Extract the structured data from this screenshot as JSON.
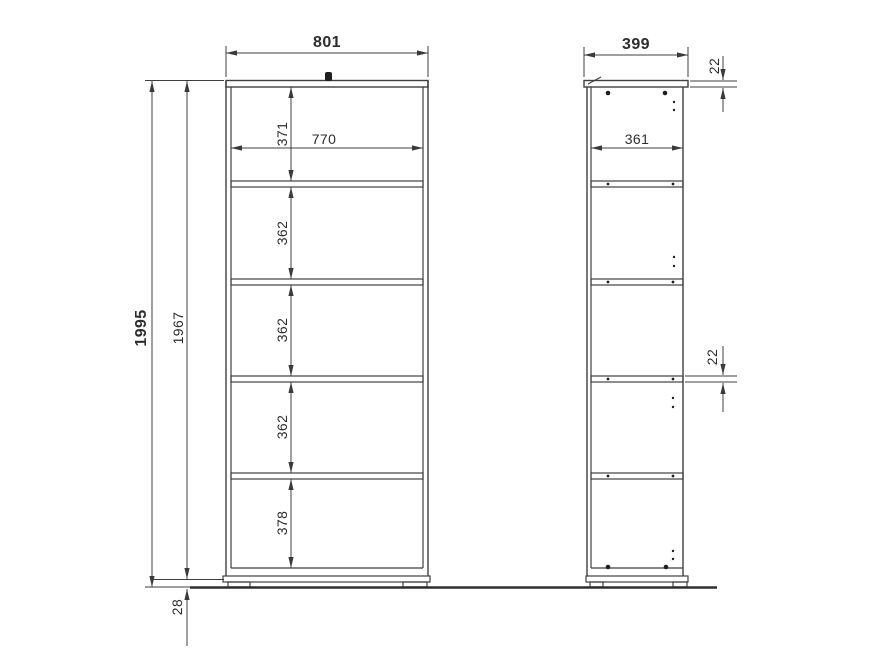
{
  "front_view": {
    "overall_width": "801",
    "interior_width": "770",
    "overall_height": "1995",
    "cabinet_height": "1967",
    "plinth_height": "28",
    "compartment_heights": [
      "371",
      "362",
      "362",
      "362",
      "378"
    ]
  },
  "side_view": {
    "overall_depth": "399",
    "interior_depth": "361",
    "top_panel_thickness": "22",
    "shelf_thickness": "22"
  },
  "colors": {
    "background": "#ffffff",
    "line": "#3f3f3f",
    "text": "#2d2d2d"
  }
}
